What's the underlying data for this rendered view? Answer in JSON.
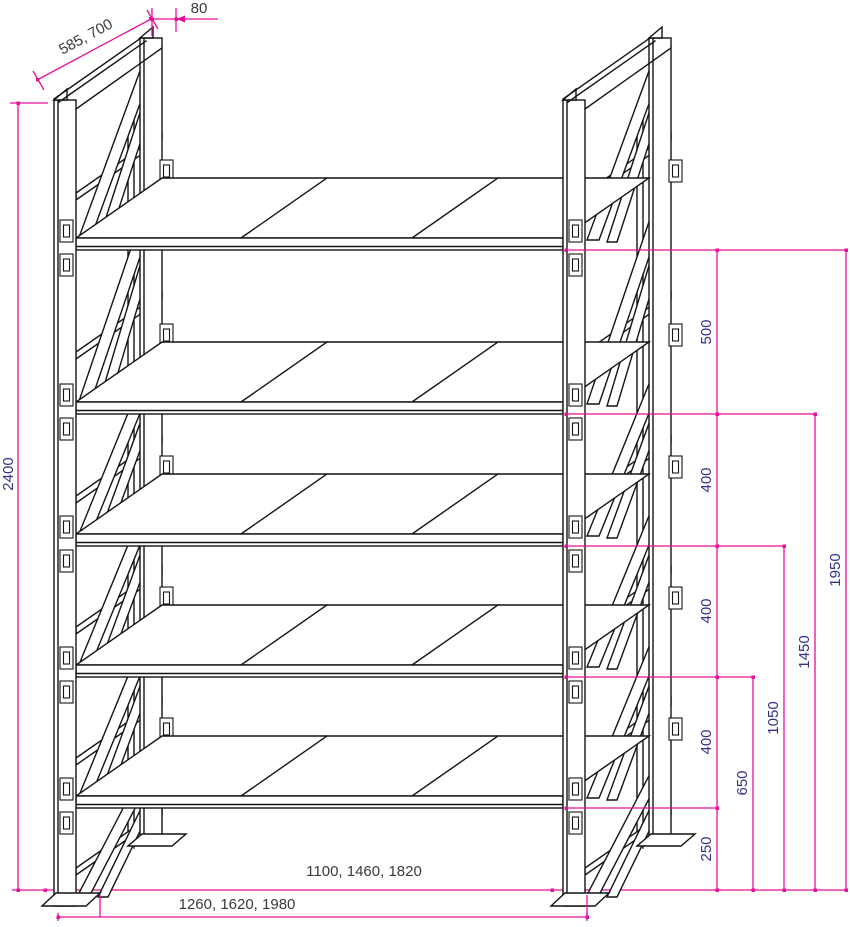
{
  "dimensions": {
    "frame_height": "2400",
    "frame_depth_options": "585, 700",
    "post_depth": "80",
    "gap_level5": "500",
    "gap_level4": "400",
    "gap_level3": "400",
    "gap_level2": "400",
    "gap_level1": "250",
    "shelf_height_2": "650",
    "shelf_height_3": "1050",
    "shelf_height_4": "1450",
    "shelf_height_5": "1950",
    "clear_width_options": "1100, 1460, 1820",
    "overall_width_options": "1260, 1620, 1980"
  },
  "colors": {
    "dimension_line": "#e60f9a",
    "dimension_label_rotated": "#32328c",
    "dimension_label_horizontal": "#3a3a3a",
    "drawing_line": "#141414",
    "background": "#ffffff"
  }
}
